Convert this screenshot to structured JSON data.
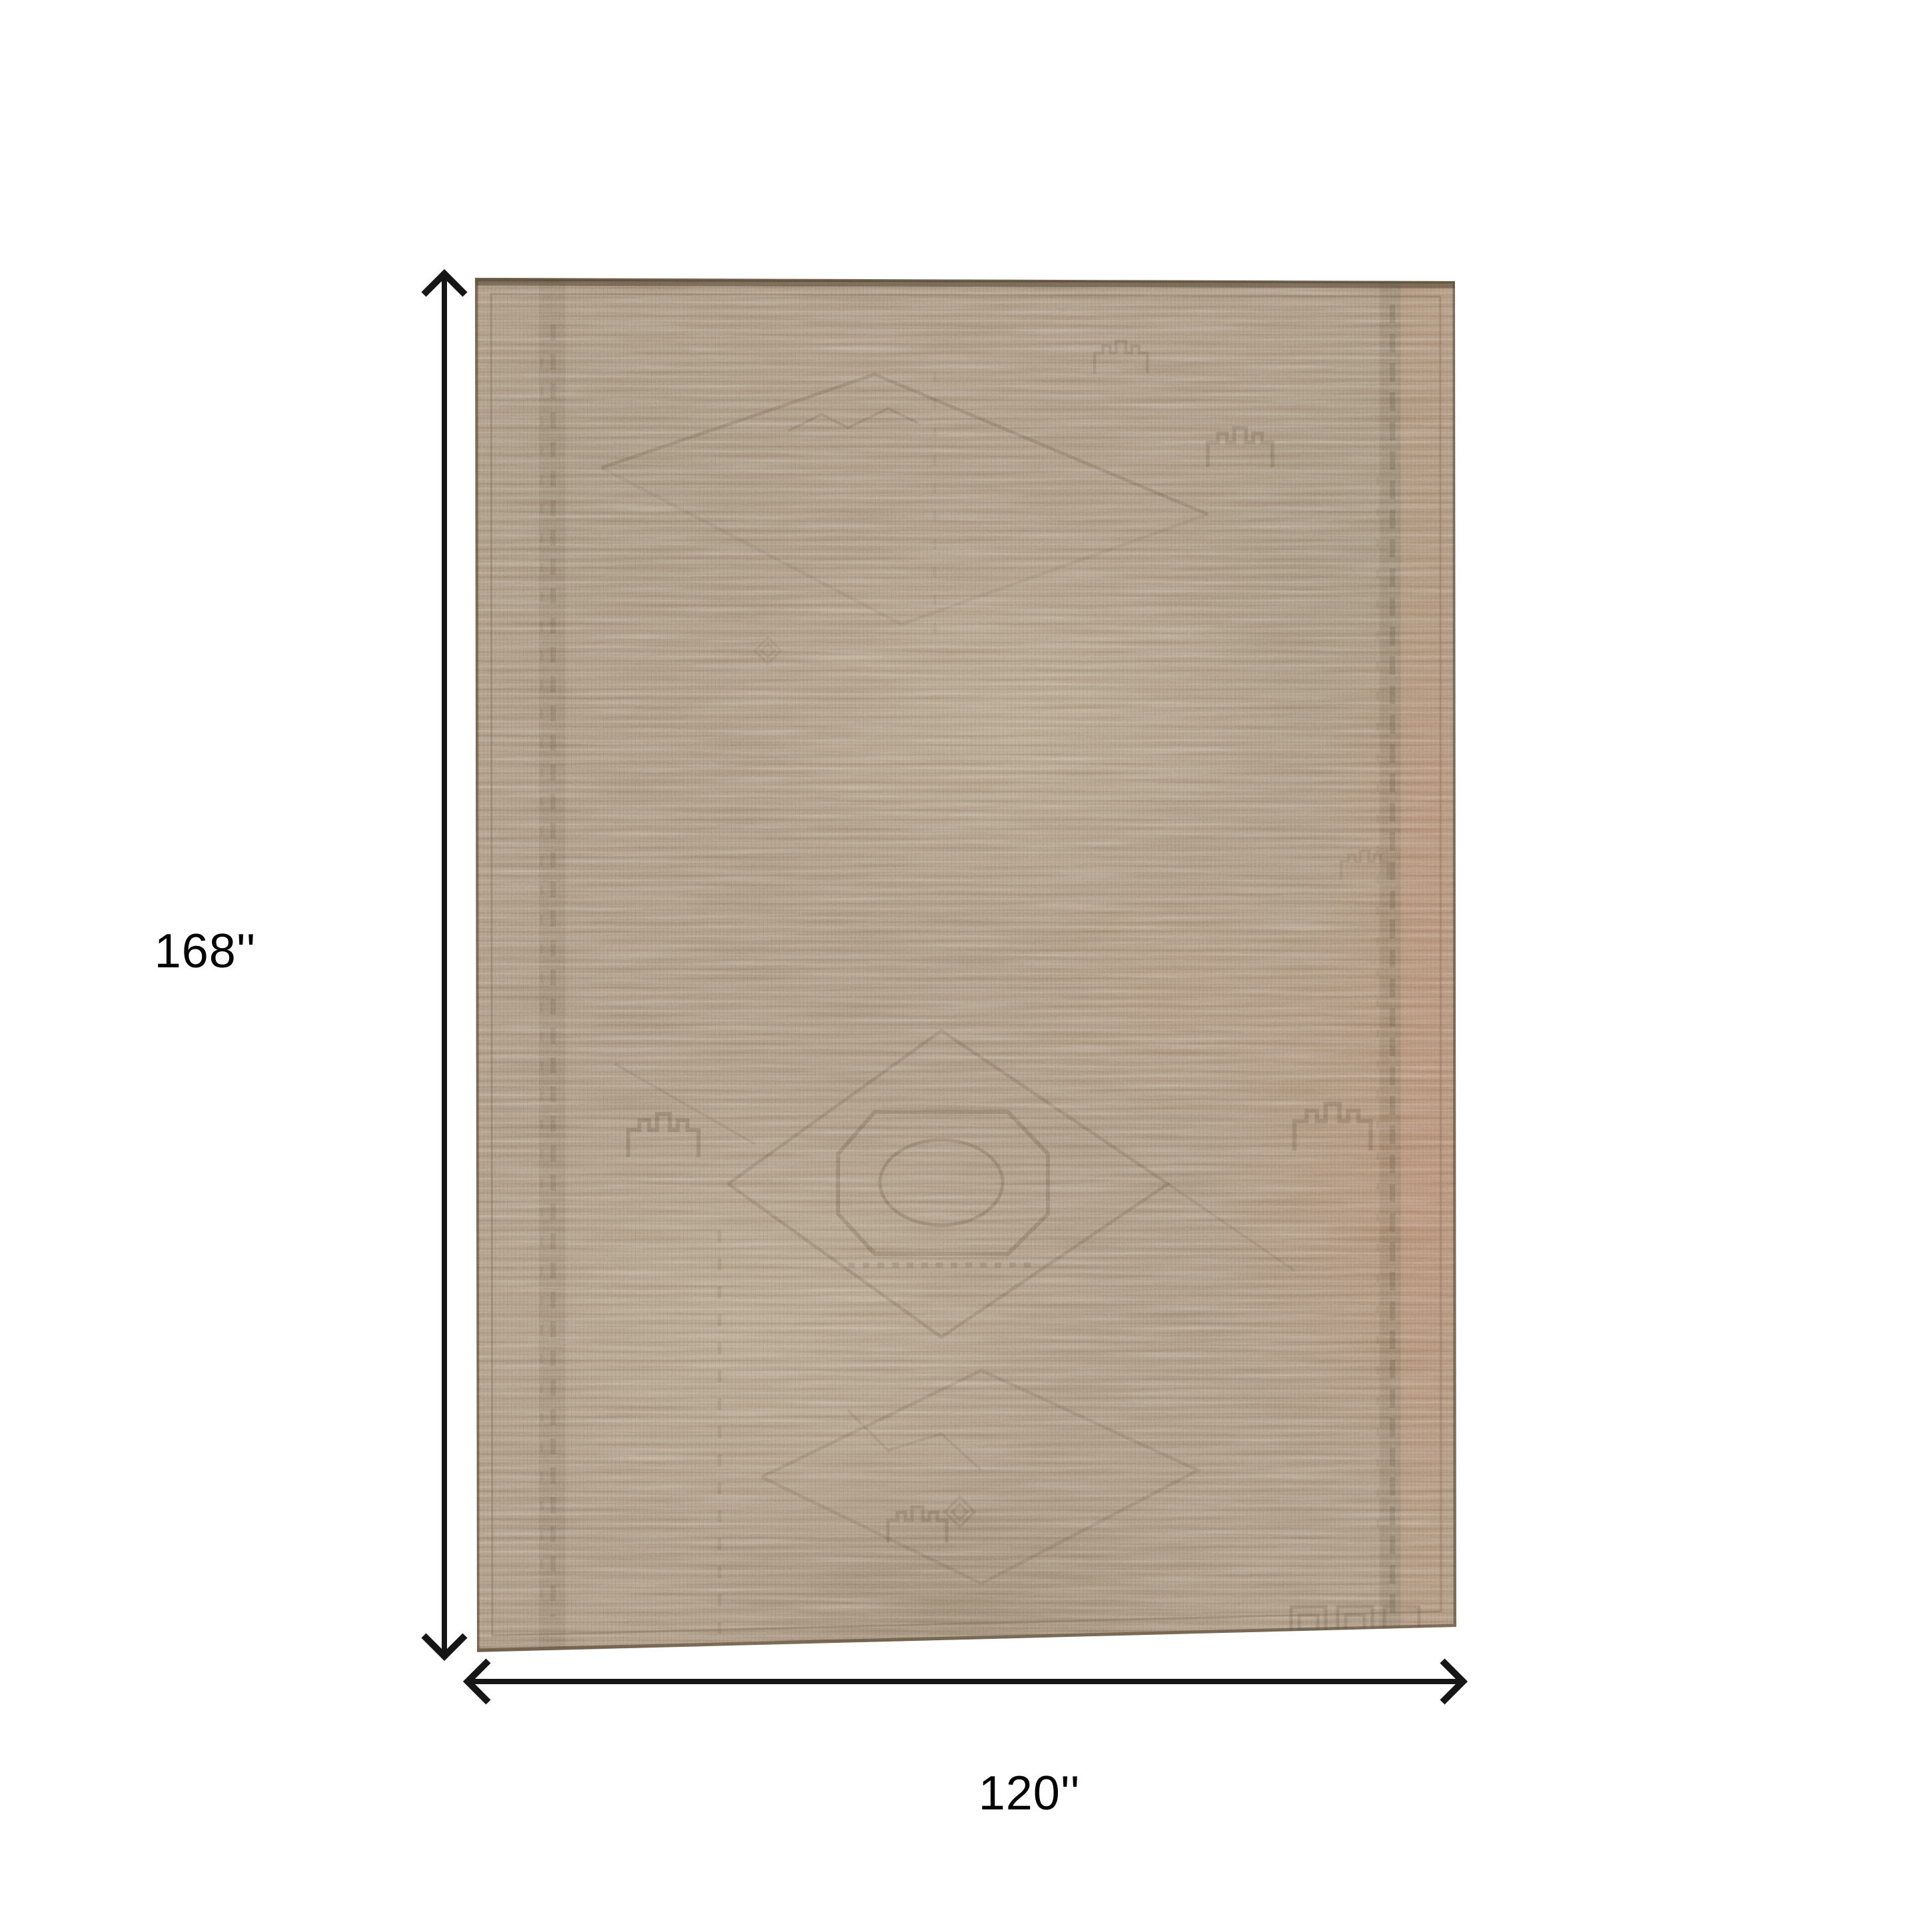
{
  "image": {
    "kind": "product-dimensions-diagram",
    "subject": "vintage washed tan area rug, top view"
  },
  "dimensions": {
    "height_label": "168''",
    "width_label": "120''"
  },
  "icons": {
    "height_arrow": "vertical-double-arrow-icon",
    "width_arrow": "horizontal-double-arrow-icon"
  },
  "colors": {
    "background": "#ffffff",
    "arrow": "#161616",
    "label_text": "#000000",
    "rug_base": "#ab9881",
    "rug_dark_streak": "#6f5f4b",
    "rug_light_fleck": "#d8ccb2",
    "rug_rust_accent": "#bb8668",
    "rug_sage_accent": "#97987f",
    "rug_edge_line": "#55452f"
  }
}
